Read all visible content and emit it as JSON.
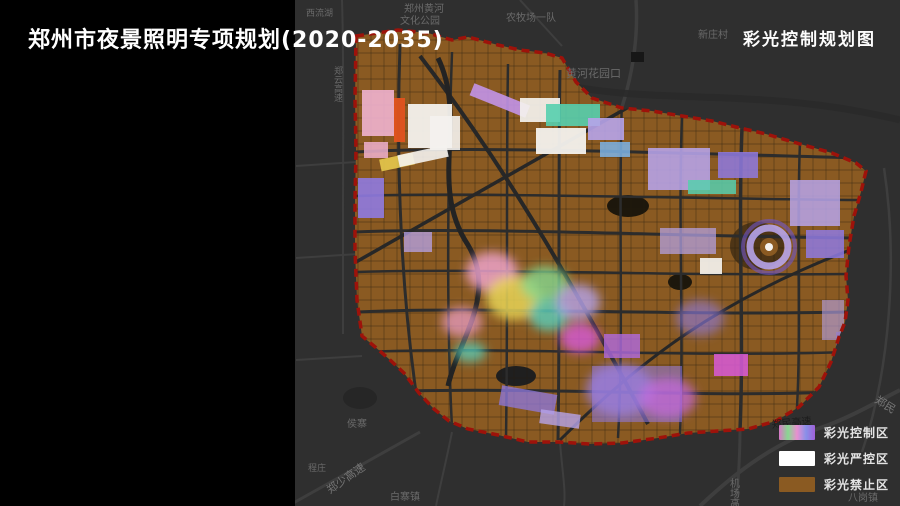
{
  "header": {
    "title": "郑州市夜景照明专项规划(2020-2035)",
    "map_title": "彩光控制规划图"
  },
  "legend": {
    "items": [
      {
        "label": "彩光控制区",
        "swatch_style": "background:linear-gradient(90deg,#d878c8,#88d890,#e890d0,#8890e8,#a060d8)"
      },
      {
        "label": "彩光严控区",
        "swatch_style": "background:#ffffff"
      },
      {
        "label": "彩光禁止区",
        "swatch_style": "background:#8a5a22"
      }
    ]
  },
  "map_labels": [
    {
      "text": "西流湖"
    },
    {
      "text": "郑州黄河"
    },
    {
      "text": "文化公园"
    },
    {
      "text": "农牧场一队"
    },
    {
      "text": "黄河花园口"
    },
    {
      "text": "新庄村"
    },
    {
      "text": "郑云高速"
    },
    {
      "text": "侯寨"
    },
    {
      "text": "程庄"
    },
    {
      "text": "郑少高速"
    },
    {
      "text": "白寨镇"
    },
    {
      "text": "机场高速"
    },
    {
      "text": "郑民高速"
    },
    {
      "text": "郑民"
    },
    {
      "text": "八岗镇"
    }
  ],
  "colors": {
    "background": "#2f2f2f",
    "panel_black": "#000000",
    "prohibited_brown": "#8a5a22",
    "boundary_red": "#9e120a",
    "strict_white": "#f4f2ee",
    "control_violet": "#8f7ae0",
    "control_magenta": "#d85ad8",
    "control_teal": "#57cfae",
    "control_yellow": "#e8d456",
    "control_pink": "#f0a6d2"
  }
}
